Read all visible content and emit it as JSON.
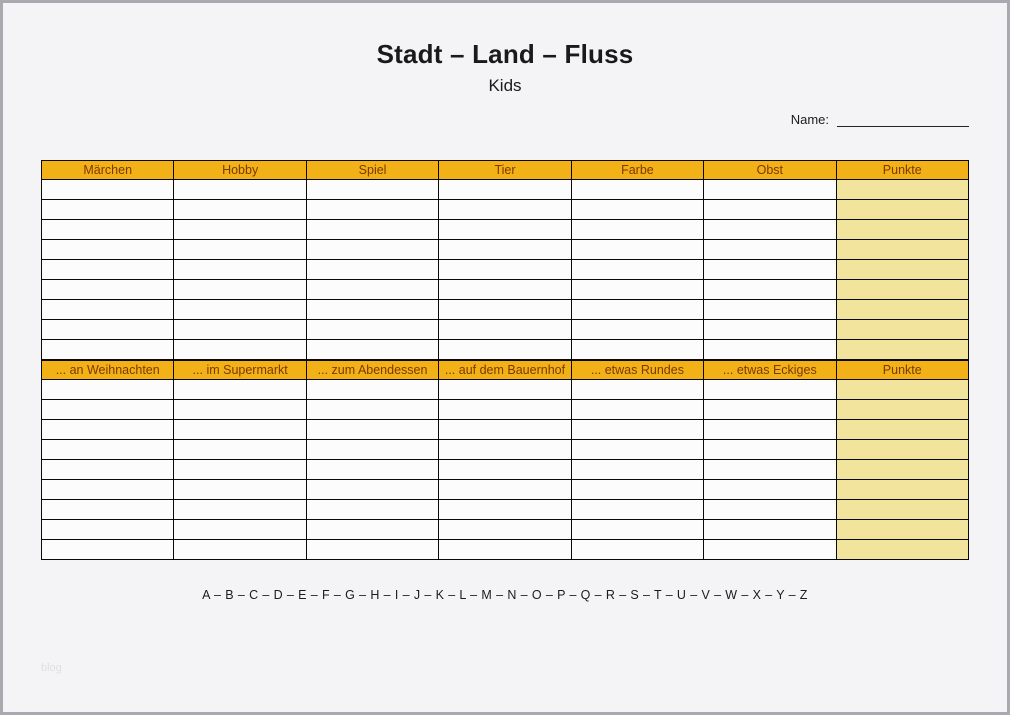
{
  "page": {
    "title": "Stadt – Land – Fluss",
    "subtitle": "Kids",
    "name_label": "Name:",
    "alphabet": "A – B – C – D – E – F – G – H – I – J – K – L – M – N – O – P – Q – R – S – T – U – V – W – X – Y – Z",
    "watermark": "blog"
  },
  "tables": [
    {
      "headers": [
        "Märchen",
        "Hobby",
        "Spiel",
        "Tier",
        "Farbe",
        "Obst",
        "Punkte"
      ],
      "empty_rows": 9
    },
    {
      "headers": [
        "... an Weihnachten",
        "... im Supermarkt",
        "... zum Abendessen",
        "... auf dem Bauernhof",
        "... etwas Rundes",
        "... etwas Eckiges",
        "Punkte"
      ],
      "empty_rows": 9
    }
  ],
  "colors": {
    "header_fill": "#F3B118",
    "header_text": "#7A3A00",
    "points_fill": "#F3E49D",
    "grid": "#0A0A0A",
    "page_bg": "#F4F4F6"
  }
}
